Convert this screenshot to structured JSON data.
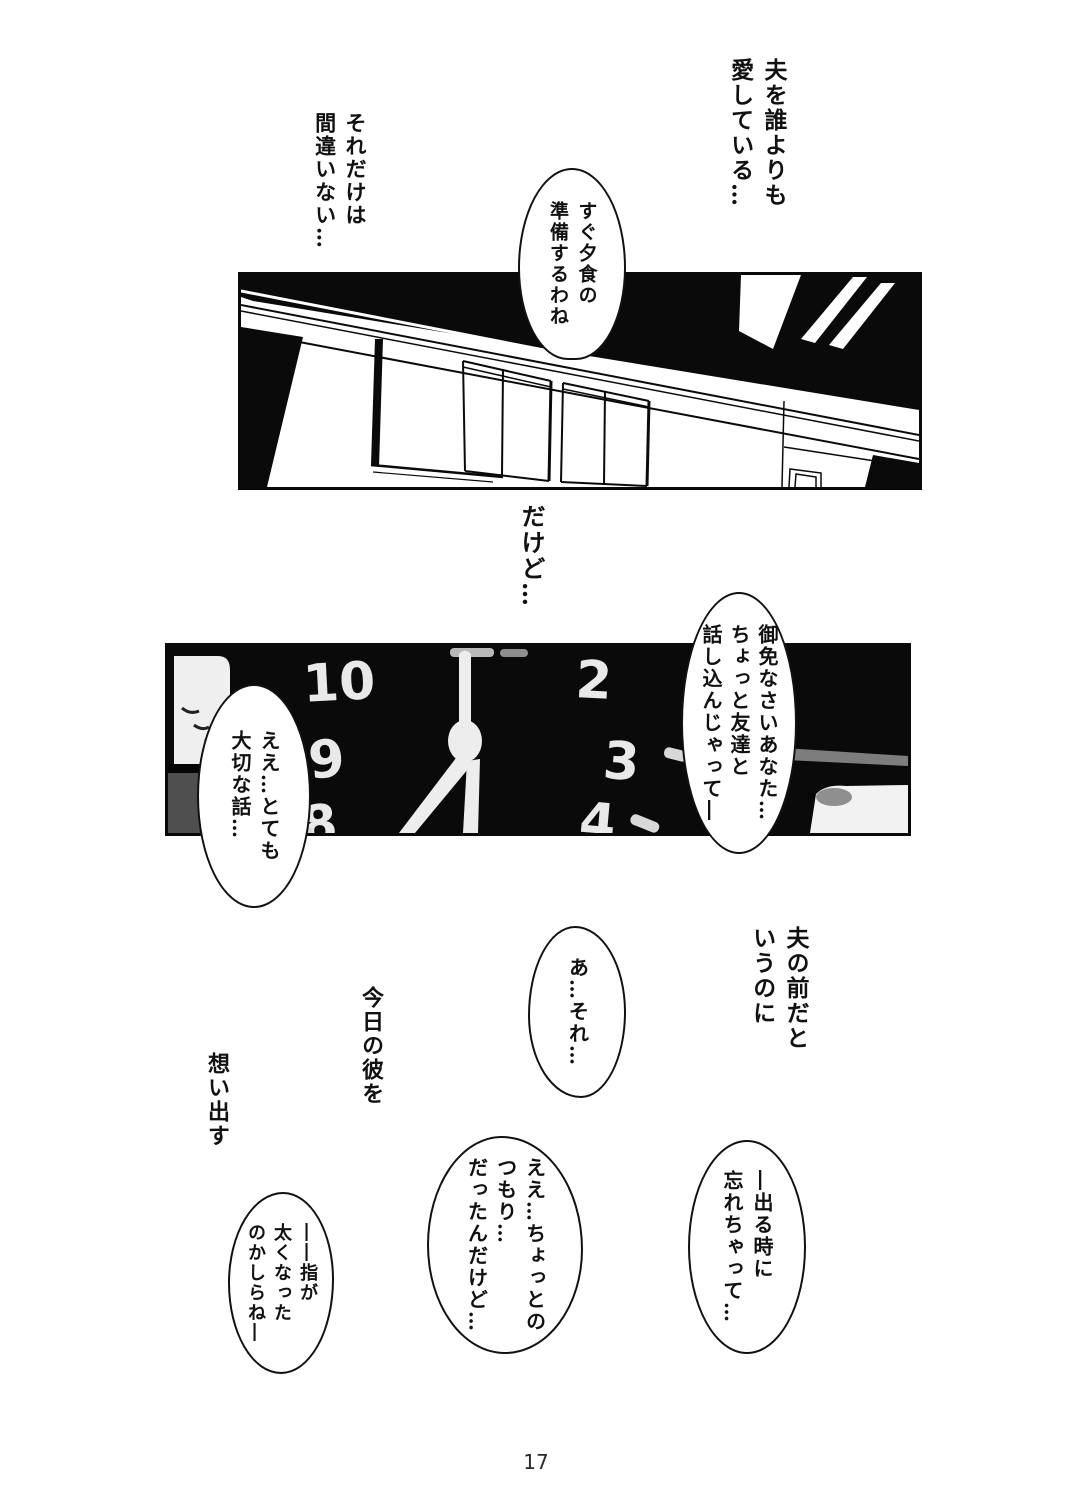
{
  "page": {
    "number": "17",
    "paper_color": "#ffffff",
    "ink_color": "#111111",
    "panel_black": "#0a0a0a"
  },
  "narration": {
    "love_husband": {
      "lines": [
        "夫を誰よりも",
        "愛している…"
      ]
    },
    "no_mistake": {
      "lines": [
        "それだけは",
        "間違いない…"
      ]
    },
    "however": {
      "lines": [
        "だけど…"
      ]
    },
    "front_of_husband": {
      "lines": [
        "夫の前だと",
        "いうのに"
      ]
    },
    "todays_him": {
      "lines": [
        "今日の彼を"
      ]
    },
    "recall": {
      "lines": [
        "想い出す"
      ]
    }
  },
  "speech_bubbles": {
    "prepare_dinner": {
      "lines": [
        "すぐ夕食の",
        "準備するわね"
      ]
    },
    "sorry_dear": {
      "lines": [
        "御免なさいあなた…",
        "ちょっと友達と",
        "話し込んじゃって―"
      ]
    },
    "important_talk": {
      "lines": [
        "ええ…とても",
        "大切な話…"
      ]
    },
    "ah_that": {
      "lines": [
        "あ…それ…"
      ]
    },
    "just_meant_a_little": {
      "lines": [
        "ええ…ちょっとの",
        "つもり…",
        "だったんだけど…"
      ]
    },
    "forgot_when_leaving": {
      "lines": [
        "―出る時に",
        "忘れちゃって…"
      ]
    },
    "fingers_thicker": {
      "lines": [
        "――指が",
        "太くなった",
        "のかしらね―"
      ]
    }
  },
  "clock": {
    "numerals": {
      "ten": "10",
      "two": "2",
      "nine": "9",
      "three": "3",
      "eight": "8",
      "four": "4"
    }
  }
}
